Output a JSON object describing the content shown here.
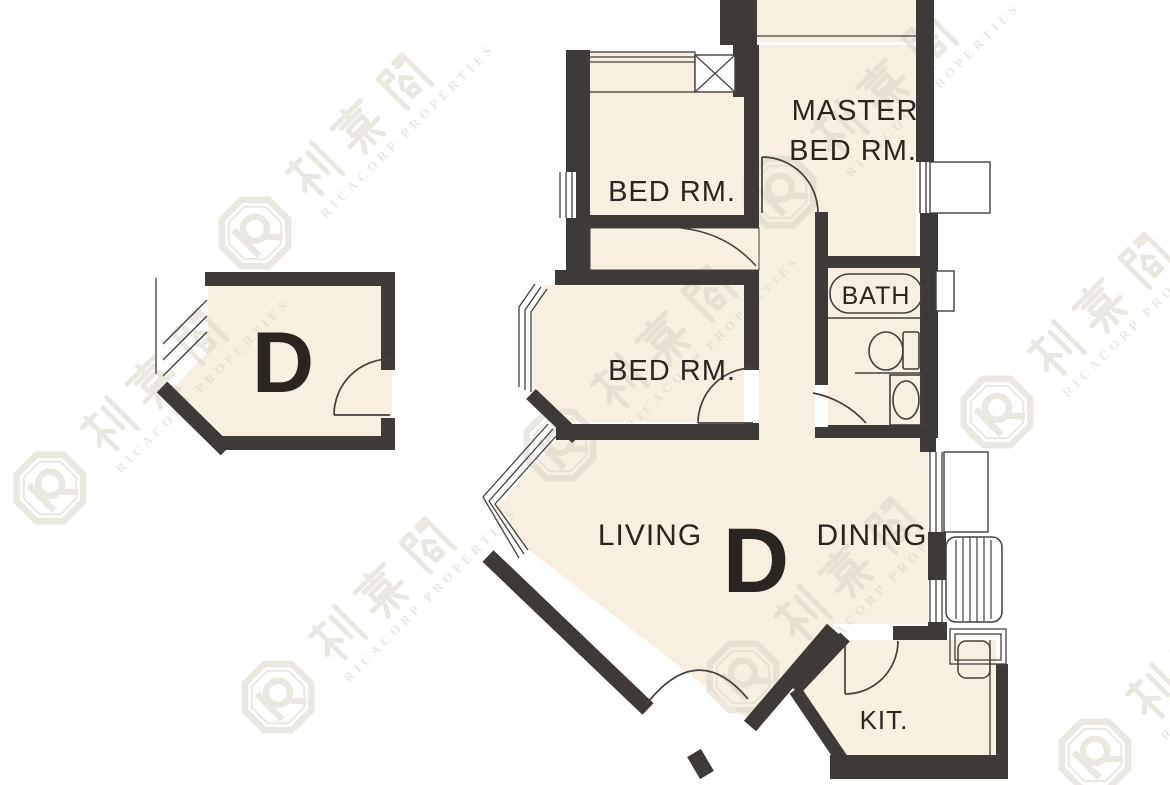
{
  "floor_plan": {
    "unit_label": "D",
    "key_plan": {
      "unit_label": "D"
    },
    "rooms": [
      {
        "id": "master_bedroom",
        "label_line1": "MASTER",
        "label_line2": "BED RM."
      },
      {
        "id": "bedroom_1",
        "label": "BED RM."
      },
      {
        "id": "bedroom_2",
        "label": "BED RM."
      },
      {
        "id": "bathroom",
        "label": "BATH"
      },
      {
        "id": "living",
        "label": "LIVING"
      },
      {
        "id": "dining",
        "label": "DINING"
      },
      {
        "id": "kitchen",
        "label": "KIT."
      }
    ],
    "fixtures": [
      "bathtub",
      "toilet",
      "wash-basin",
      "kitchen-sink",
      "ac-platform",
      "louver-grille"
    ],
    "watermark": {
      "chinese": "利嘉閣",
      "latin": "RICACORP PROPERTIES",
      "logo": "ricacorp-octagon-logo"
    },
    "colors": {
      "background": "#ffffff",
      "wall": "#3e3a37",
      "room_fill": "#f7efe2",
      "thin_line": "#44403d",
      "label_text": "#2b2521",
      "watermark": "#d9d2c7"
    }
  }
}
